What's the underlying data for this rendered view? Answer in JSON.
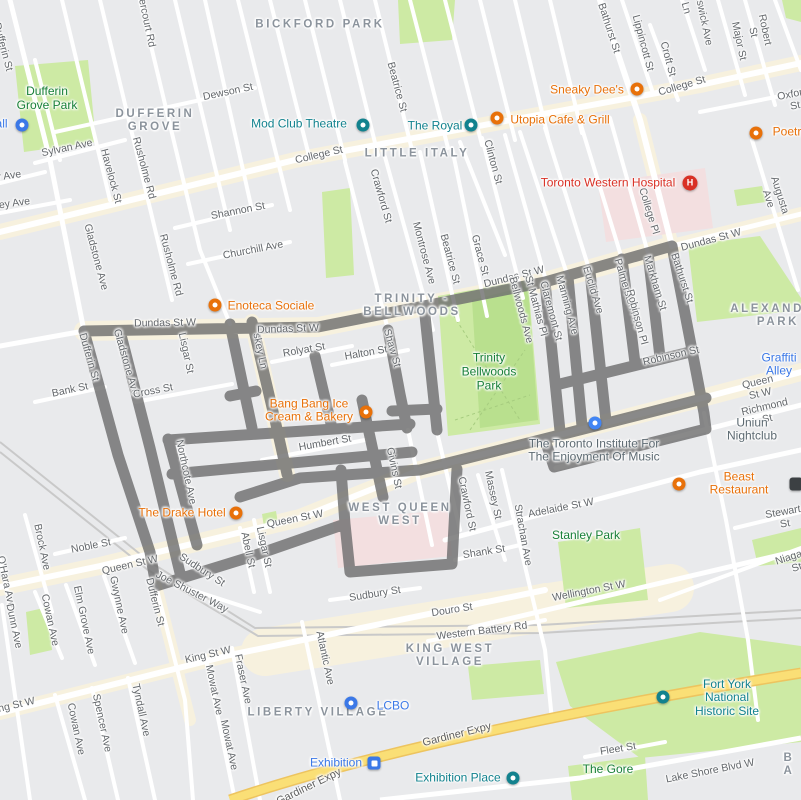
{
  "colors": {
    "route": "#6f6f6f",
    "poi-orange": "#e8710a",
    "poi-teal": "#12828e",
    "poi-blue": "#3b78e7",
    "poi-red": "#d93025",
    "park-label": "#188038"
  },
  "map": {
    "neighborhoods": [
      {
        "text": "BICKFORD PARK",
        "x": 320,
        "y": 25
      },
      {
        "text": "DUFFERIN\nGROVE",
        "x": 155,
        "y": 121
      },
      {
        "text": "LITTLE ITALY",
        "x": 417,
        "y": 154
      },
      {
        "text": "TRINITY -\nBELLWOODS",
        "x": 412,
        "y": 306
      },
      {
        "text": "ALEXANDRA\nPARK",
        "x": 778,
        "y": 316
      },
      {
        "text": "WEST QUEEN\nWEST",
        "x": 400,
        "y": 515
      },
      {
        "text": "KING WEST\nVILLAGE",
        "x": 450,
        "y": 656
      },
      {
        "text": "LIBERTY VILLAGE",
        "x": 318,
        "y": 713
      },
      {
        "text": "B A",
        "x": 789,
        "y": 765
      }
    ],
    "park_labels": [
      {
        "text": "Dufferin\nGrove Park",
        "x": 47,
        "y": 99
      },
      {
        "text": "Trinity\nBellwoods\nPark",
        "x": 489,
        "y": 372
      },
      {
        "text": "Stanley Park",
        "x": 586,
        "y": 536
      },
      {
        "text": "The Gore",
        "x": 608,
        "y": 770
      }
    ],
    "streets": [
      {
        "text": "Dundas St W",
        "x": 165,
        "y": 323,
        "r": -1
      },
      {
        "text": "Dundas St W",
        "x": 288,
        "y": 329,
        "r": -2
      },
      {
        "text": "Dundas St W",
        "x": 514,
        "y": 277,
        "r": -14
      },
      {
        "text": "Dundas St W",
        "x": 711,
        "y": 240,
        "r": -15
      },
      {
        "text": "Dufferin St",
        "x": 3,
        "y": 47,
        "r": 75
      },
      {
        "text": "Dufferin St",
        "x": 89,
        "y": 357,
        "r": 74
      },
      {
        "text": "Dufferin St",
        "x": 155,
        "y": 602,
        "r": 76
      },
      {
        "text": "Gladstone Ave",
        "x": 126,
        "y": 362,
        "r": 74
      },
      {
        "text": "Gladstone Ave",
        "x": 96,
        "y": 257,
        "r": 75
      },
      {
        "text": "Dovercourt Rd",
        "x": 145,
        "y": 14,
        "r": 78
      },
      {
        "text": "Havelock St",
        "x": 111,
        "y": 176,
        "r": 75
      },
      {
        "text": "Rusholme Rd",
        "x": 144,
        "y": 168,
        "r": 75
      },
      {
        "text": "Rusholme Rd",
        "x": 171,
        "y": 265,
        "r": 75
      },
      {
        "text": "Sylvan Ave",
        "x": 67,
        "y": 148,
        "r": -12
      },
      {
        "text": "Muir Ave",
        "x": 1,
        "y": 177,
        "r": -8
      },
      {
        "text": "Lindsey Ave",
        "x": 2,
        "y": 205,
        "r": -8
      },
      {
        "text": "Dewson St",
        "x": 228,
        "y": 92,
        "r": -12
      },
      {
        "text": "Shannon St",
        "x": 238,
        "y": 211,
        "r": -11
      },
      {
        "text": "Churchill Ave",
        "x": 253,
        "y": 250,
        "r": -11
      },
      {
        "text": "College St",
        "x": 319,
        "y": 155,
        "r": -13
      },
      {
        "text": "College St",
        "x": 682,
        "y": 86,
        "r": -16
      },
      {
        "text": "Oxford St",
        "x": 794,
        "y": 100,
        "r": -11
      },
      {
        "text": "Bathurst St",
        "x": 609,
        "y": 28,
        "r": 72
      },
      {
        "text": "Bathurst St",
        "x": 682,
        "y": 278,
        "r": 72
      },
      {
        "text": "Lippincott St",
        "x": 643,
        "y": 43,
        "r": 75
      },
      {
        "text": "Croft St",
        "x": 668,
        "y": 59,
        "r": 75
      },
      {
        "text": "Brunswick Ave",
        "x": 702,
        "y": 12,
        "r": 78
      },
      {
        "text": "Ln",
        "x": 686,
        "y": 8,
        "r": 75
      },
      {
        "text": "Major St",
        "x": 739,
        "y": 41,
        "r": 78
      },
      {
        "text": "Robert St",
        "x": 759,
        "y": 31,
        "r": 78
      },
      {
        "text": "Augusta Ave",
        "x": 774,
        "y": 197,
        "r": 72
      },
      {
        "text": "College Pl",
        "x": 649,
        "y": 211,
        "r": 73
      },
      {
        "text": "Lisgar St",
        "x": 186,
        "y": 353,
        "r": 78
      },
      {
        "text": "Lisgar St",
        "x": 264,
        "y": 547,
        "r": 78
      },
      {
        "text": "Cross St",
        "x": 153,
        "y": 391,
        "r": -11
      },
      {
        "text": "skey Ln",
        "x": 260,
        "y": 351,
        "r": 78
      },
      {
        "text": "Rolyat St",
        "x": 304,
        "y": 350,
        "r": -10
      },
      {
        "text": "Halton St",
        "x": 366,
        "y": 353,
        "r": -10
      },
      {
        "text": "Shaw St",
        "x": 392,
        "y": 348,
        "r": 74
      },
      {
        "text": "Crawford St",
        "x": 381,
        "y": 196,
        "r": 74
      },
      {
        "text": "Crawford St",
        "x": 467,
        "y": 504,
        "r": 78
      },
      {
        "text": "Montrose Ave",
        "x": 424,
        "y": 253,
        "r": 75
      },
      {
        "text": "Beatrice St",
        "x": 397,
        "y": 87,
        "r": 75
      },
      {
        "text": "Beatrice St",
        "x": 450,
        "y": 259,
        "r": 75
      },
      {
        "text": "Grace St",
        "x": 480,
        "y": 255,
        "r": 75
      },
      {
        "text": "Clinton St",
        "x": 493,
        "y": 162,
        "r": 75
      },
      {
        "text": "Bellwoods Ave",
        "x": 521,
        "y": 310,
        "r": 75
      },
      {
        "text": "St Mathias Pl",
        "x": 536,
        "y": 306,
        "r": 75
      },
      {
        "text": "Claremont St",
        "x": 551,
        "y": 311,
        "r": 75
      },
      {
        "text": "Manning Ave",
        "x": 567,
        "y": 305,
        "r": 75
      },
      {
        "text": "Euclid Ave",
        "x": 593,
        "y": 290,
        "r": 73
      },
      {
        "text": "Palmerston Ave",
        "x": 628,
        "y": 294,
        "r": 73
      },
      {
        "text": "Markham St",
        "x": 655,
        "y": 283,
        "r": 73
      },
      {
        "text": "Robinson Pl",
        "x": 637,
        "y": 317,
        "r": 75
      },
      {
        "text": "Robinson St",
        "x": 671,
        "y": 356,
        "r": -13
      },
      {
        "text": "Queen St W",
        "x": 130,
        "y": 565,
        "r": -13
      },
      {
        "text": "Queen St W",
        "x": 295,
        "y": 519,
        "r": -11
      },
      {
        "text": "Queen St W",
        "x": 759,
        "y": 388,
        "r": -13
      },
      {
        "text": "Richmond St",
        "x": 766,
        "y": 413,
        "r": -13
      },
      {
        "text": "Adelaide St W",
        "x": 561,
        "y": 508,
        "r": -11
      },
      {
        "text": "Stewart St",
        "x": 784,
        "y": 518,
        "r": -10
      },
      {
        "text": "Niagara St",
        "x": 795,
        "y": 562,
        "r": -18
      },
      {
        "text": "Wellington St W",
        "x": 589,
        "y": 591,
        "r": -11
      },
      {
        "text": "Shank St",
        "x": 484,
        "y": 552,
        "r": -9
      },
      {
        "text": "Strachan Ave",
        "x": 523,
        "y": 535,
        "r": 80
      },
      {
        "text": "Massey St",
        "x": 493,
        "y": 495,
        "r": 78
      },
      {
        "text": "Sudbury St",
        "x": 202,
        "y": 570,
        "r": 33
      },
      {
        "text": "Sudbury St",
        "x": 375,
        "y": 594,
        "r": -9
      },
      {
        "text": "Joe Shuster Way",
        "x": 192,
        "y": 592,
        "r": 27
      },
      {
        "text": "Abell St",
        "x": 248,
        "y": 550,
        "r": 78
      },
      {
        "text": "Noble St",
        "x": 91,
        "y": 546,
        "r": -11
      },
      {
        "text": "Brock Ave",
        "x": 42,
        "y": 547,
        "r": 78
      },
      {
        "text": "O'Hara Ave",
        "x": 6,
        "y": 582,
        "r": 78
      },
      {
        "text": "Gwynne Ave",
        "x": 119,
        "y": 605,
        "r": 78
      },
      {
        "text": "Elm Grove Ave",
        "x": 84,
        "y": 620,
        "r": 78
      },
      {
        "text": "Cowan Ave",
        "x": 50,
        "y": 620,
        "r": 78
      },
      {
        "text": "Cowan Ave",
        "x": 76,
        "y": 729,
        "r": 78
      },
      {
        "text": "Dunn Ave",
        "x": 14,
        "y": 626,
        "r": 78
      },
      {
        "text": "Spencer Ave",
        "x": 102,
        "y": 723,
        "r": 78
      },
      {
        "text": "Tyndall Ave",
        "x": 141,
        "y": 710,
        "r": 78
      },
      {
        "text": "Mowat Ave",
        "x": 214,
        "y": 690,
        "r": 78
      },
      {
        "text": "Mowat Ave",
        "x": 229,
        "y": 745,
        "r": 78
      },
      {
        "text": "Fraser Ave",
        "x": 243,
        "y": 679,
        "r": 78
      },
      {
        "text": "King St W",
        "x": 208,
        "y": 655,
        "r": -13
      },
      {
        "text": "King St W",
        "x": 12,
        "y": 706,
        "r": -13
      },
      {
        "text": "Atlantic Ave",
        "x": 325,
        "y": 658,
        "r": 78
      },
      {
        "text": "Douro St",
        "x": 452,
        "y": 610,
        "r": -9
      },
      {
        "text": "Western Battery Rd",
        "x": 482,
        "y": 631,
        "r": -7
      },
      {
        "text": "Fleet St",
        "x": 618,
        "y": 749,
        "r": -9
      },
      {
        "text": "Lake Shore Blvd W",
        "x": 710,
        "y": 771,
        "r": -11
      },
      {
        "text": "Humbert St",
        "x": 325,
        "y": 443,
        "r": -10
      },
      {
        "text": "Bank St",
        "x": 70,
        "y": 390,
        "r": -12
      },
      {
        "text": "Northcote Ave",
        "x": 186,
        "y": 472,
        "r": 78
      },
      {
        "text": "Givins St",
        "x": 394,
        "y": 468,
        "r": 78
      }
    ],
    "highways": [
      {
        "text": "Gardiner Expy",
        "x": 457,
        "y": 735,
        "r": -14
      },
      {
        "text": "Gardiner Expy",
        "x": 309,
        "y": 787,
        "r": -26
      }
    ],
    "pois": [
      {
        "name": "mod-club-theatre",
        "text": "Mod Club Theatre",
        "x": 299,
        "y": 124,
        "kind": "teal",
        "icon": {
          "k": "badge-teal",
          "x": 363,
          "y": 125
        }
      },
      {
        "name": "the-royal",
        "text": "The Royal",
        "x": 435,
        "y": 126,
        "kind": "teal",
        "icon": {
          "k": "badge-teal",
          "x": 471,
          "y": 125
        }
      },
      {
        "name": "utopia-cafe-grill",
        "text": "Utopia Cafe & Grill",
        "x": 560,
        "y": 120,
        "kind": "orange",
        "icon": {
          "k": "pin-orange",
          "x": 497,
          "y": 118
        }
      },
      {
        "name": "sneaky-dees",
        "text": "Sneaky Dee's",
        "x": 587,
        "y": 90,
        "kind": "orange",
        "icon": {
          "k": "pin-orange",
          "x": 637,
          "y": 89
        }
      },
      {
        "name": "poetry",
        "text": "Poetry",
        "x": 790,
        "y": 132,
        "kind": "orange",
        "icon": {
          "k": "pin-orange",
          "x": 756,
          "y": 133
        }
      },
      {
        "name": "toronto-western-hospital",
        "text": "Toronto Western Hospital",
        "x": 608,
        "y": 183,
        "kind": "red",
        "icon": {
          "k": "circle-red",
          "x": 690,
          "y": 183
        }
      },
      {
        "name": "enoteca-sociale",
        "text": "Enoteca Sociale",
        "x": 271,
        "y": 306,
        "kind": "orange",
        "icon": {
          "k": "pin-orange",
          "x": 215,
          "y": 305
        }
      },
      {
        "name": "bang-bang-ice-cream",
        "text": "Bang Bang Ice\nCream & Bakery",
        "x": 309,
        "y": 411,
        "kind": "orange",
        "icon": {
          "k": "pin-orange",
          "x": 366,
          "y": 412
        }
      },
      {
        "name": "the-drake-hotel",
        "text": "The Drake Hotel",
        "x": 182,
        "y": 513,
        "kind": "orange",
        "icon": {
          "k": "pin-orange",
          "x": 236,
          "y": 513
        }
      },
      {
        "name": "beast-restaurant",
        "text": "Beast Restaurant",
        "x": 739,
        "y": 484,
        "kind": "orange",
        "icon": {
          "k": "pin-orange",
          "x": 679,
          "y": 484
        }
      },
      {
        "name": "toronto-institute-music",
        "text": "The Toronto Institute For\nThe Enjoyment Of Music",
        "x": 594,
        "y": 451,
        "kind": "gray",
        "icon": {
          "k": "pin-blue",
          "x": 595,
          "y": 423
        }
      },
      {
        "name": "uniun-nightclub",
        "text": "Uniun Nightclub",
        "x": 752,
        "y": 430,
        "kind": "gray",
        "icon": null
      },
      {
        "name": "graffiti-alley",
        "text": "Graffiti Alley",
        "x": 779,
        "y": 365,
        "kind": "blue",
        "icon": null
      },
      {
        "name": "dufferin-mall",
        "text": "Dufferin Mall",
        "x": -26,
        "y": 124,
        "kind": "blue",
        "icon": {
          "k": "badge-blue",
          "x": 22,
          "y": 125
        }
      },
      {
        "name": "lcbo",
        "text": "LCBO",
        "x": 393,
        "y": 706,
        "kind": "blue",
        "icon": {
          "k": "badge-blue",
          "x": 351,
          "y": 703
        }
      },
      {
        "name": "exhibition-station",
        "text": "Exhibition",
        "x": 336,
        "y": 763,
        "kind": "blue",
        "icon": {
          "k": "transit",
          "x": 374,
          "y": 763
        }
      },
      {
        "name": "exhibition-place",
        "text": "Exhibition Place",
        "x": 458,
        "y": 778,
        "kind": "teal",
        "icon": {
          "k": "badge-teal",
          "x": 513,
          "y": 778
        }
      },
      {
        "name": "fort-york",
        "text": "Fort York National\nHistoric Site",
        "x": 727,
        "y": 698,
        "kind": "teal",
        "icon": {
          "k": "badge-teal",
          "x": 663,
          "y": 697
        }
      }
    ],
    "extra_icons": [
      {
        "name": "partial-poi-icon",
        "k": "dark",
        "x": 796,
        "y": 484
      }
    ]
  }
}
